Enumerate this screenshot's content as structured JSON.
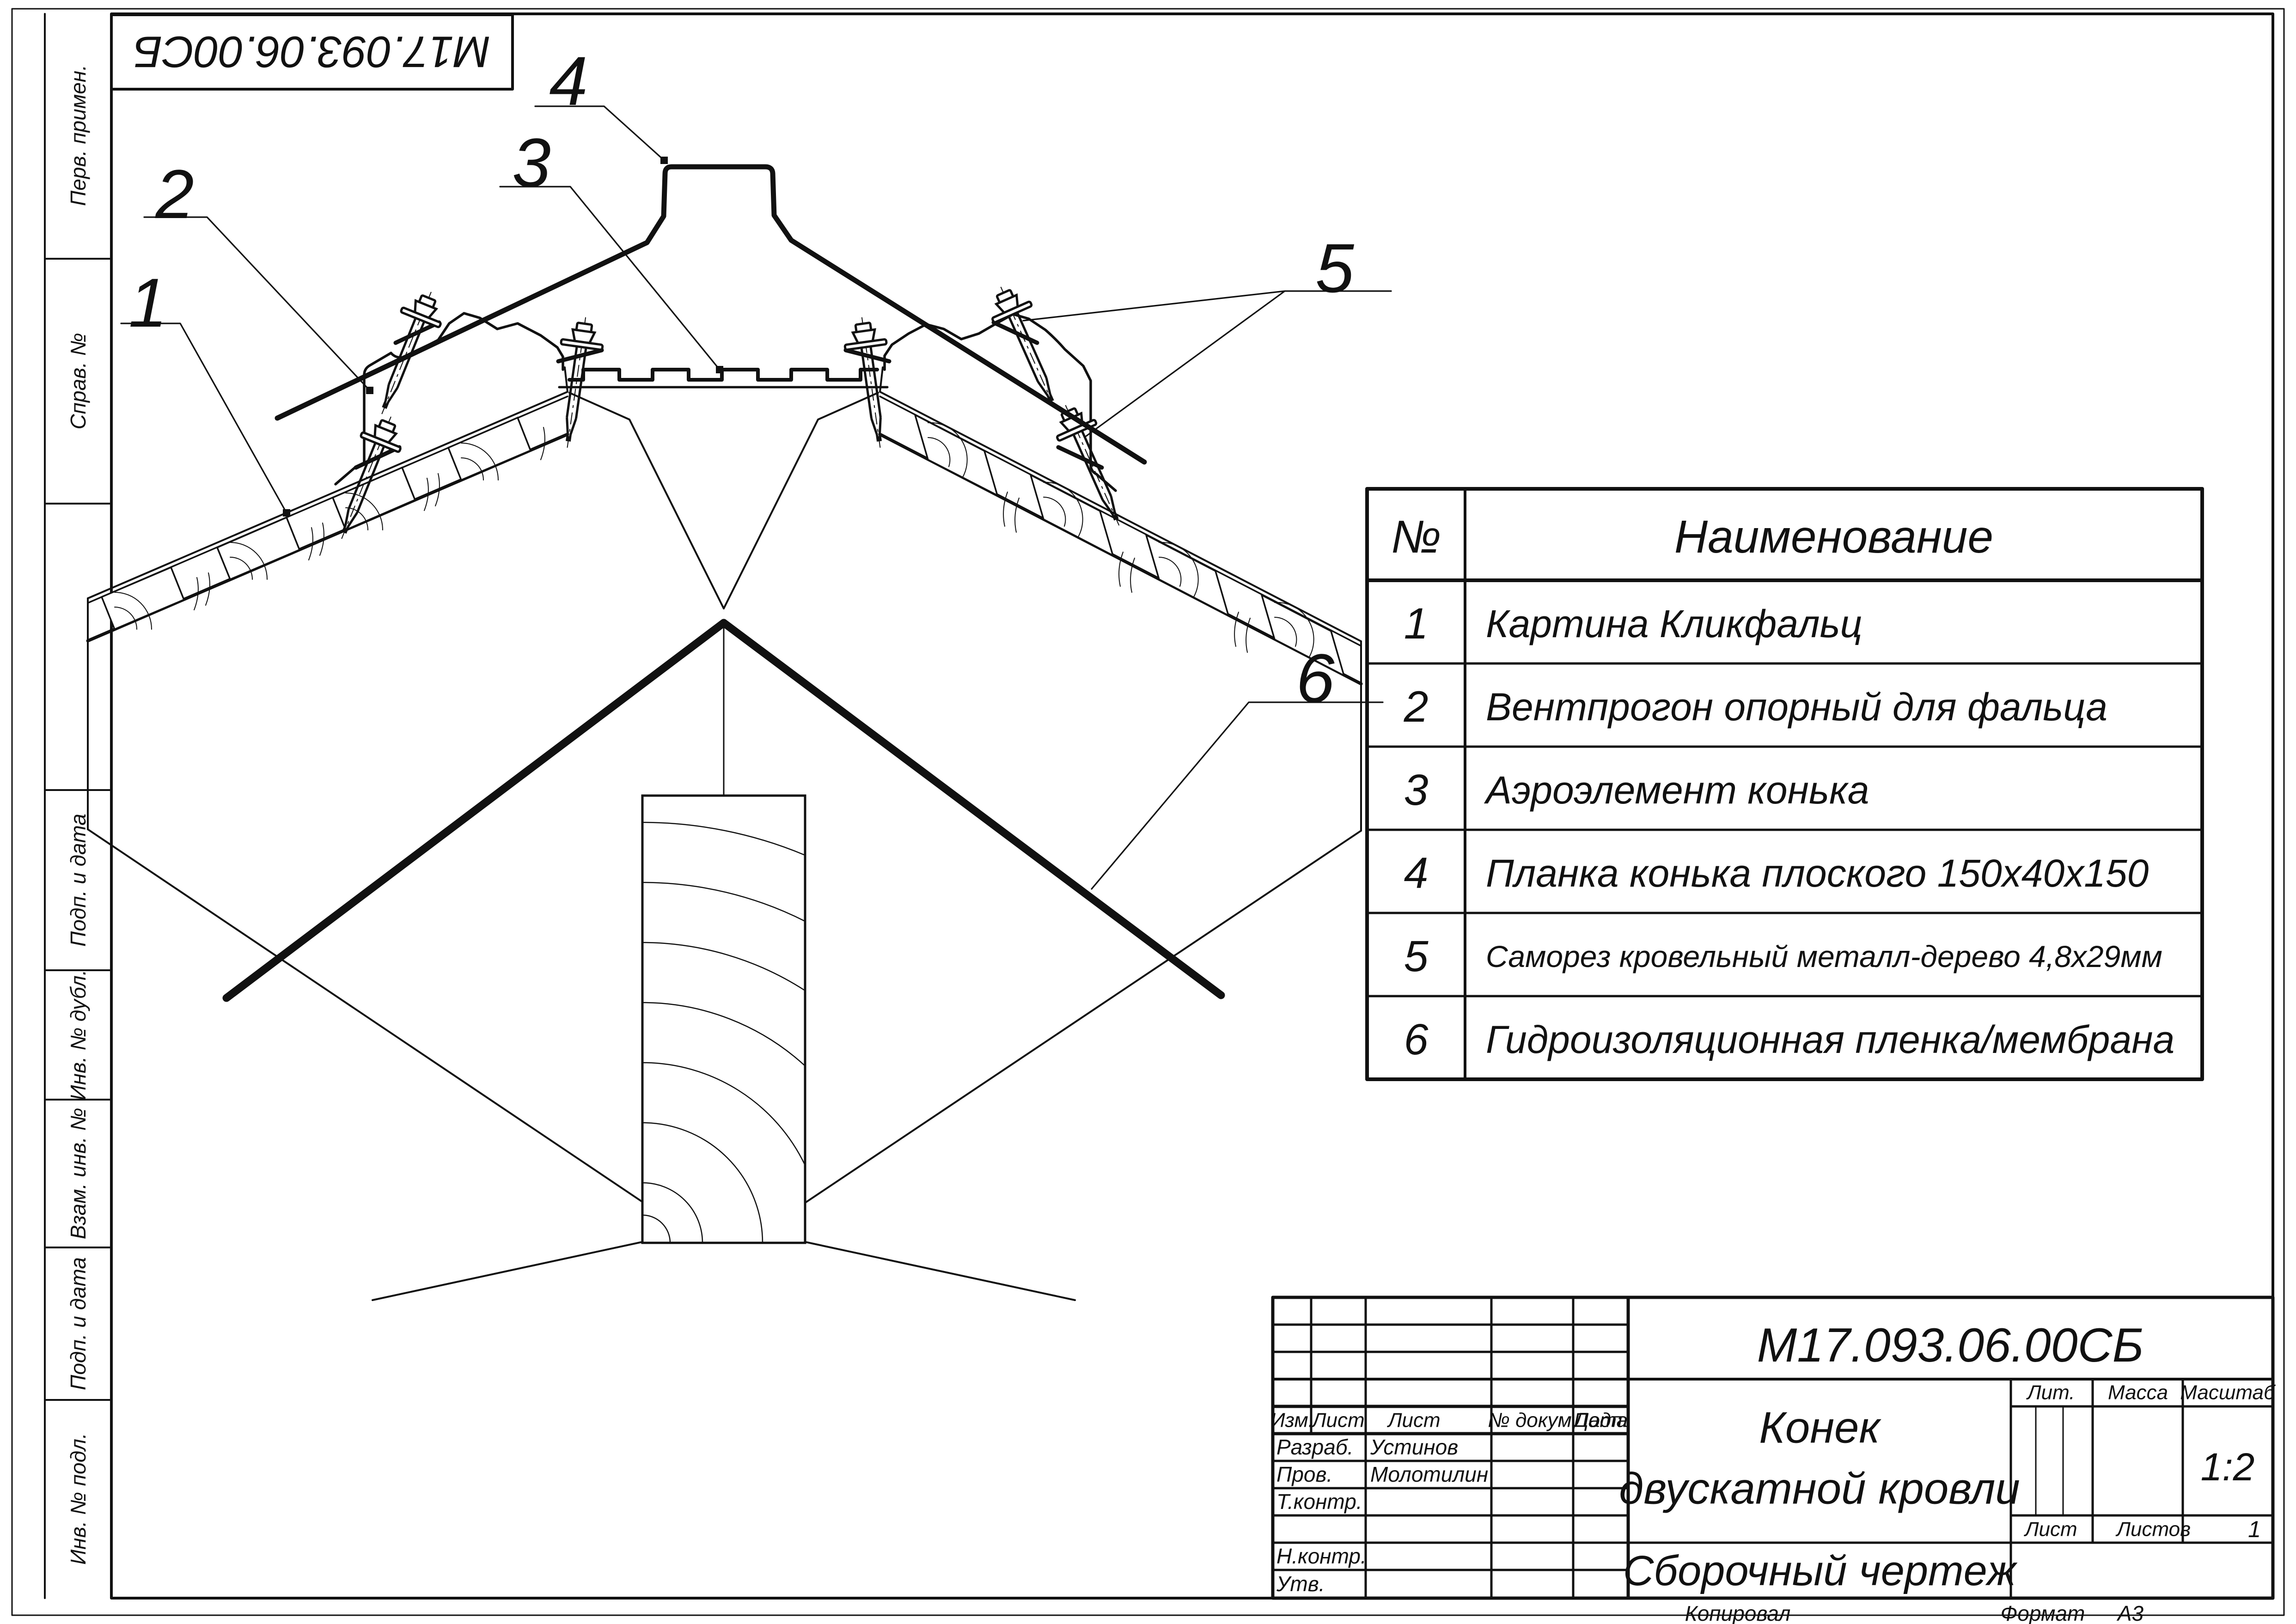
{
  "sheet": {
    "background": "#ffffff",
    "ink": "#111111"
  },
  "top_stamp": {
    "doc_number_mirrored": "М17.093.06.00СБ"
  },
  "margin_labels": [
    "Перв. примен.",
    "Справ. №",
    "Подп. и дата",
    "Инв. № дубл.",
    "Взам. инв. №",
    "Подп. и дата",
    "Инв. № подл."
  ],
  "callouts": [
    "1",
    "2",
    "3",
    "4",
    "5",
    "6"
  ],
  "parts_table": {
    "col_num": "№",
    "col_name": "Наименование",
    "rows": [
      [
        "1",
        "Картина Кликфальц"
      ],
      [
        "2",
        "Вентпрогон опорный для фальца"
      ],
      [
        "3",
        "Аэроэлемент конька"
      ],
      [
        "4",
        "Планка конька плоского 150х40х150"
      ],
      [
        "5",
        "Саморез кровельный металл-дерево 4,8х29мм"
      ],
      [
        "6",
        "Гидроизоляционная пленка/мембрана"
      ]
    ]
  },
  "title_block": {
    "doc_number": "М17.093.06.00СБ",
    "name_line1": "Конек",
    "name_line2": "двускатной кровли",
    "doc_type": "Сборочный чертеж",
    "headers": {
      "izm": "Изм.",
      "list": "Лист",
      "dokum": "№ докум.",
      "podp": "Подп.",
      "data": "Дата"
    },
    "roles": {
      "razrab": "Разраб.",
      "prov": "Пров.",
      "tkontr": "Т.контр.",
      "nkontr": "Н.контр.",
      "utv": "Утв."
    },
    "people": {
      "razrab": "Устинов",
      "prov": "Молотилин"
    },
    "lit": "Лит.",
    "massa": "Масса",
    "masshtab": "Масштаб",
    "scale": "1:2",
    "list_label": "Лист",
    "listov_label": "Листов",
    "listov_value": "1"
  },
  "footer": {
    "kopiroval": "Копировал",
    "format_label": "Формат",
    "format_value": "А3"
  }
}
